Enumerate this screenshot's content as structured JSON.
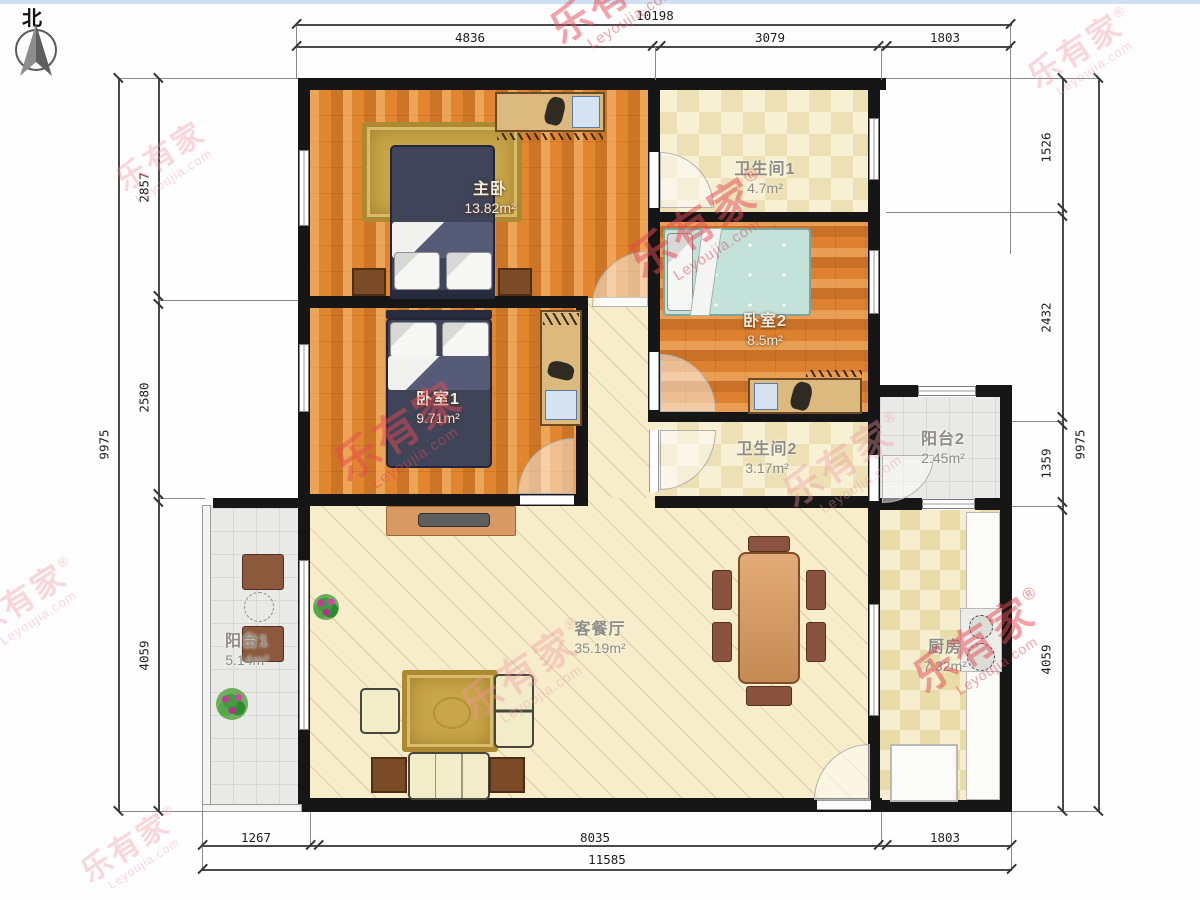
{
  "north": {
    "label": "北"
  },
  "watermark": {
    "brand": "乐有家",
    "reg": "®",
    "domain": "Leyoujia.com"
  },
  "rooms": [
    {
      "id": "master-bedroom",
      "name": "主卧",
      "area": "13.82m²"
    },
    {
      "id": "bathroom-1",
      "name": "卫生间1",
      "area": "4.7m²"
    },
    {
      "id": "bedroom-2",
      "name": "卧室2",
      "area": "8.5m²"
    },
    {
      "id": "bedroom-1",
      "name": "卧室1",
      "area": "9.71m²"
    },
    {
      "id": "bathroom-2",
      "name": "卫生间2",
      "area": "3.17m²"
    },
    {
      "id": "balcony-2",
      "name": "阳台2",
      "area": "2.45m²"
    },
    {
      "id": "living-dining",
      "name": "客餐厅",
      "area": "35.19m²"
    },
    {
      "id": "kitchen",
      "name": "厨房",
      "area": "7.32m²"
    },
    {
      "id": "balcony-1",
      "name": "阳台1",
      "area": "5.14m²"
    }
  ],
  "dimensions": {
    "top": {
      "total": "10198",
      "segments": [
        "4836",
        "3079",
        "1803"
      ]
    },
    "left": {
      "total": "9975",
      "segments": [
        "2857",
        "2580",
        "4059"
      ]
    },
    "right": {
      "total": "9975",
      "segments": [
        "1526",
        "2432",
        "1359",
        "4059"
      ]
    },
    "bottom": {
      "total": "11585",
      "segments": [
        "1267",
        "8035",
        "1803"
      ]
    }
  }
}
